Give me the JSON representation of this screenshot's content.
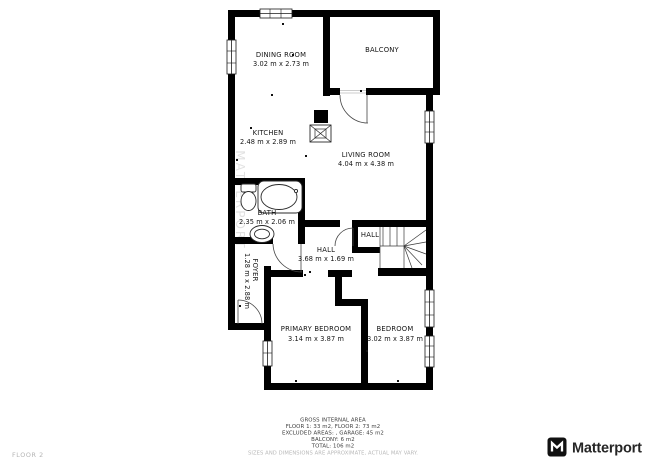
{
  "plan": {
    "floor_label": "FLOOR 2",
    "watermark": "MATTERPORT",
    "rooms": {
      "dining": {
        "name": "DINING ROOM",
        "dims": "3.02 m x 2.73 m"
      },
      "balcony": {
        "name": "BALCONY"
      },
      "kitchen": {
        "name": "KITCHEN",
        "dims": "2.48 m x 2.89 m"
      },
      "living": {
        "name": "LIVING ROOM",
        "dims": "4.04 m x 4.38 m"
      },
      "bath": {
        "name": "BATH",
        "dims": "2.35 m x 2.06 m"
      },
      "hall": {
        "name": "HALL",
        "dims": "3.68 m x 1.69 m"
      },
      "hall_landing": {
        "name": "HALL"
      },
      "foyer": {
        "name": "FOYER",
        "dims": "1.28 m x 2.88 m"
      },
      "primary_bedroom": {
        "name": "PRIMARY BEDROOM",
        "dims": "3.14 m x 3.87 m"
      },
      "bedroom": {
        "name": "BEDROOM",
        "dims": "3.02 m x 3.87 m"
      }
    }
  },
  "footer": {
    "title": "GROSS INTERNAL AREA",
    "lines": [
      "FLOOR 1: 33 m2, FLOOR 2: 73 m2",
      "EXCLUDED AREAS: , GARAGE: 45 m2",
      "BALCONY: 6 m2",
      "TOTAL: 106 m2"
    ],
    "disclaimer": "SIZES AND DIMENSIONS ARE APPROXIMATE, ACTUAL MAY VARY."
  },
  "brand": {
    "name": "Matterport"
  },
  "colors": {
    "wall": "#000000",
    "text": "#141414",
    "muted": "#b4b4b4",
    "logo": "#262626"
  }
}
